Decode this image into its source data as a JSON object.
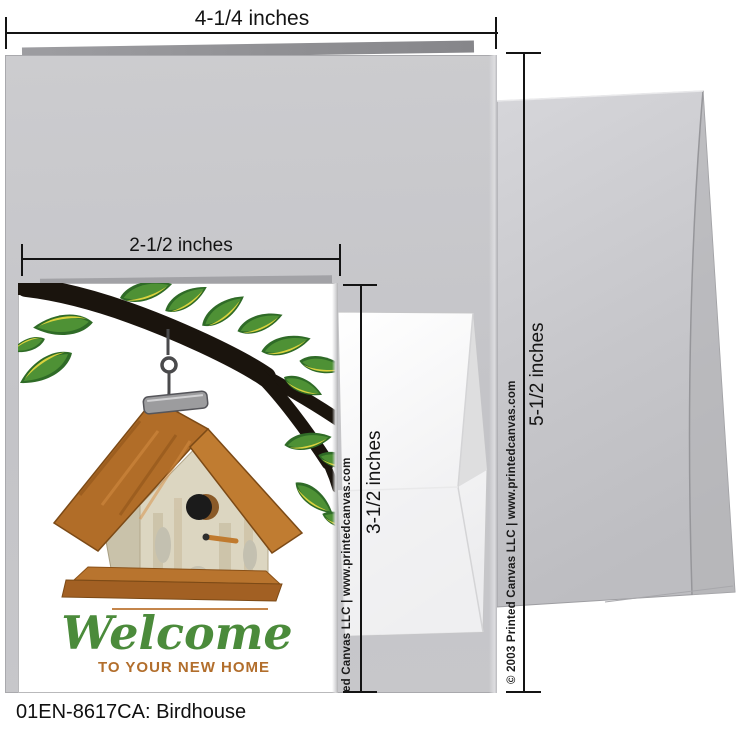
{
  "product": {
    "caption": "01EN-8617CA: Birdhouse"
  },
  "annotations": {
    "card_width": "4-1/4 inches",
    "front_width": "2-1/2 inches",
    "front_height": "3-1/2 inches",
    "card_height": "5-1/2 inches"
  },
  "card_front": {
    "greeting_script": "Welcome",
    "greeting_subtitle": "TO YOUR NEW HOME"
  },
  "watermarks": {
    "envelope": "© 2003 Printed Canvas LLC | www.printedcanvas.com",
    "card_edge_partial": "ed Canvas LLC | www.printedcanvas.com"
  },
  "colors": {
    "card_back_gray": "#c7c7cb",
    "envelope_large_gray": "#c9c9cd",
    "envelope_small_white": "#f6f6f7",
    "greeting_green": "#4b8b3b",
    "accent_brown": "#b26e2c",
    "roof_orange": "#b06c28",
    "leaf_green": "#4e9135",
    "branch_dark": "#1a140d",
    "dimension_line_black": "#141414"
  }
}
